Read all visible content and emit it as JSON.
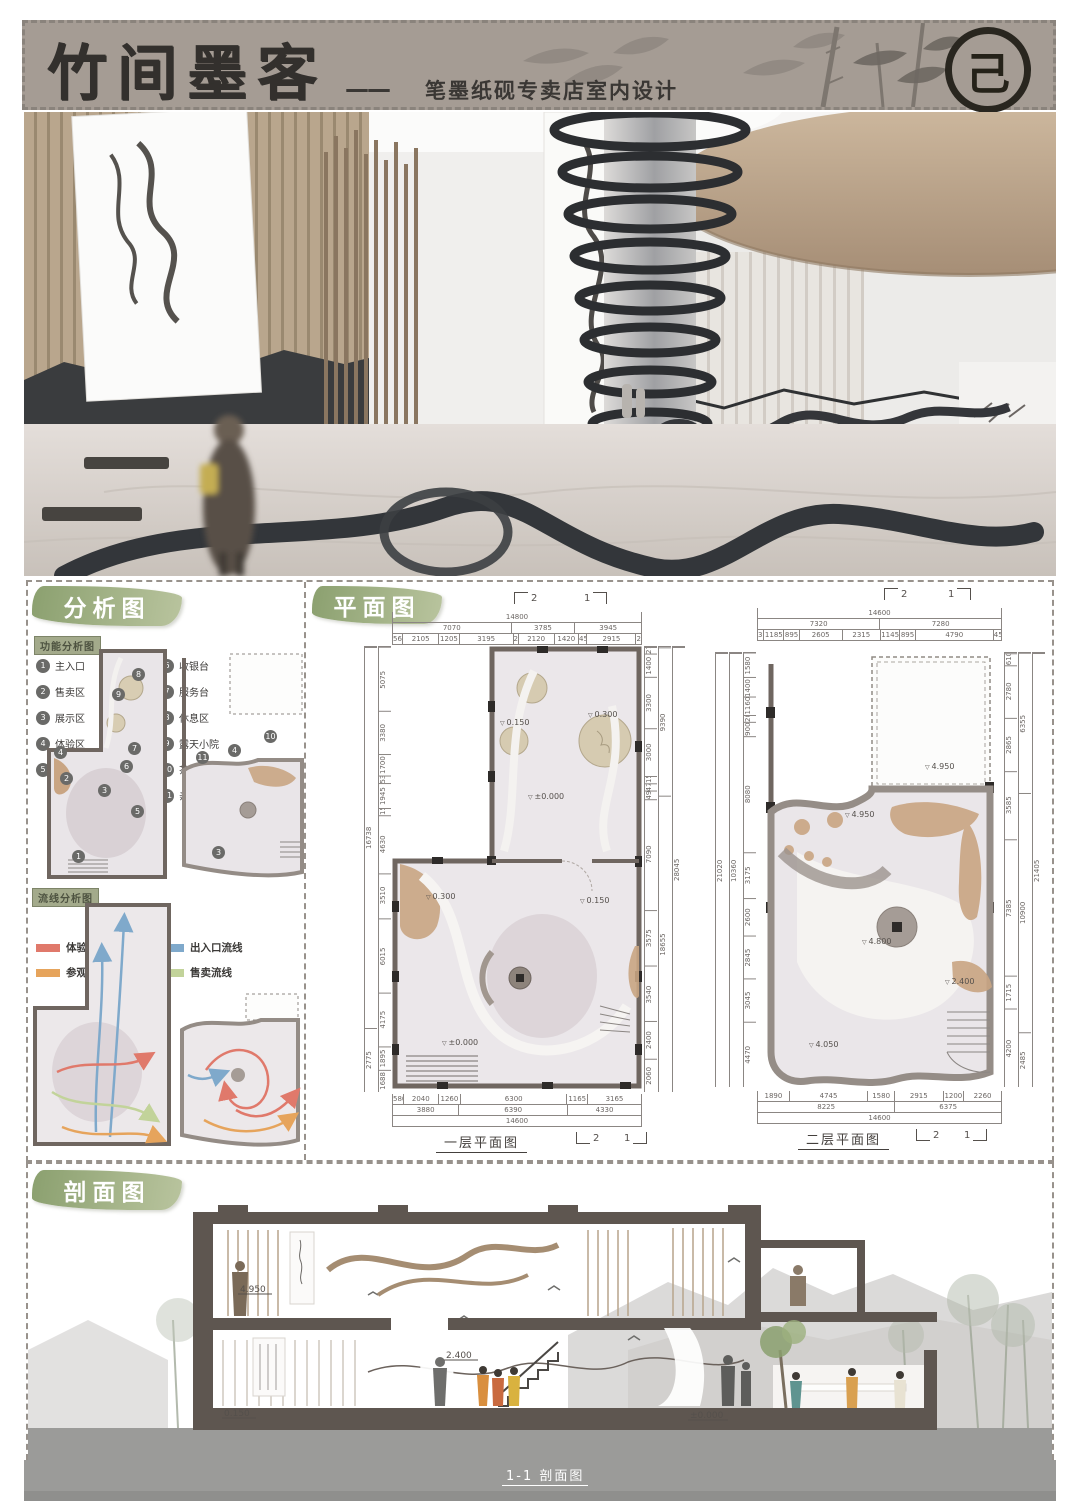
{
  "header": {
    "title": "竹间墨客",
    "dash": "——",
    "subtitle": "笔墨纸砚专卖店室内设计",
    "logo_glyph": "己"
  },
  "analysis": {
    "label": "分析图",
    "function_badge": "功能分析图",
    "circulation_badge": "流线分析图",
    "function_legend_col1": [
      {
        "num": "1",
        "label": "主入口"
      },
      {
        "num": "2",
        "label": "售卖区"
      },
      {
        "num": "3",
        "label": "展示区"
      },
      {
        "num": "4",
        "label": "体验区"
      },
      {
        "num": "5",
        "label": "储藏室"
      }
    ],
    "function_legend_col2": [
      {
        "num": "6",
        "label": "收银台"
      },
      {
        "num": "7",
        "label": "服务台"
      },
      {
        "num": "8",
        "label": "休息区"
      },
      {
        "num": "9",
        "label": "露天小院"
      },
      {
        "num": "10",
        "label": "茶饮休息区"
      },
      {
        "num": "11",
        "label": "亲子体验区"
      }
    ],
    "circulation_legend_col1": [
      {
        "label": "体验流线",
        "color": "#e0796b"
      },
      {
        "label": "参观流线",
        "color": "#e6a45c"
      }
    ],
    "circulation_legend_col2": [
      {
        "label": "出入口流线",
        "color": "#7fa9cb"
      },
      {
        "label": "售卖流线",
        "color": "#c2d39a"
      }
    ],
    "plan_a_markers": [
      "8",
      "9",
      "4",
      "7",
      "6",
      "2",
      "3",
      "5",
      "1"
    ],
    "plan_b_markers": [
      "10",
      "4",
      "11",
      "3"
    ]
  },
  "plans": {
    "label": "平面图",
    "section_marks": [
      "2",
      "1"
    ],
    "plan1": {
      "caption": "一层平面图",
      "dims_top_total": "14800",
      "dims_top_groups": [
        "7070",
        "3785",
        "3945"
      ],
      "dims_top_segs": [
        "565",
        "2105",
        "1205",
        "3195",
        "250",
        "2120",
        "1420",
        "450",
        "2915",
        "275"
      ],
      "dims_bottom_segs": [
        "580",
        "2040",
        "1260",
        "6300",
        "1165",
        "3165"
      ],
      "dims_bottom_groups": [
        "3880",
        "6390",
        "4330"
      ],
      "dims_bottom_total": "14600",
      "dims_left_segs": [
        "5075",
        "3380",
        "1700",
        "530",
        "1945",
        "150",
        "4630",
        "3510",
        "6015",
        "4175",
        "1895",
        "1688"
      ],
      "dims_left_groups": [
        "16738",
        "2775"
      ],
      "dims_right_segs": [
        "275",
        "1400",
        "3300",
        "3000",
        "150",
        "475",
        "490",
        "7090",
        "3575",
        "3540",
        "2400",
        "2060"
      ],
      "dims_right_groups": [
        "9390",
        "18655"
      ],
      "dims_right_total": "28045",
      "elevations": [
        "0.150",
        "0.300",
        "±0.000",
        "0.300",
        "0.150",
        "±0.000"
      ]
    },
    "plan2": {
      "caption": "二层平面图",
      "dims_top_total": "14600",
      "dims_top_groups": [
        "7320",
        "7280"
      ],
      "dims_top_segs": [
        "330",
        "1185",
        "895",
        "2605",
        "2315",
        "1145",
        "895",
        "4790",
        "450"
      ],
      "dims_bottom_segs": [
        "1890",
        "4745",
        "1580",
        "2915",
        "1200",
        "2260"
      ],
      "dims_bottom_groups": [
        "8225",
        "6375"
      ],
      "dims_bottom_total": "14600",
      "dims_left_segs": [
        "1580",
        "1400",
        "1160",
        "200",
        "900",
        "8080",
        "3175",
        "2600",
        "2845",
        "3045",
        "4470"
      ],
      "dims_left_groups": [
        "10360"
      ],
      "dims_left_total": "21020",
      "dims_right_segs": [
        "610",
        "2780",
        "2865",
        "3585",
        "7385",
        "1715",
        "4200"
      ],
      "dims_right_groups": [
        "6355",
        "10900",
        "2485"
      ],
      "dims_right_total": "21405",
      "elevations": [
        "4.950",
        "4.950",
        "4.800",
        "2.400",
        "4.050"
      ]
    }
  },
  "section": {
    "label": "剖面图",
    "caption": "1-1 剖面图",
    "elevations": [
      "4.950",
      "2.400",
      "0.150",
      "±0.000"
    ]
  },
  "colors": {
    "header_band": "#a59c94",
    "leaf_green": "#93a377",
    "wall": "#6f6660",
    "plan_floor": "#eae6e9",
    "tan_accent": "#c9a583",
    "ground_band": "#9b9b99"
  }
}
